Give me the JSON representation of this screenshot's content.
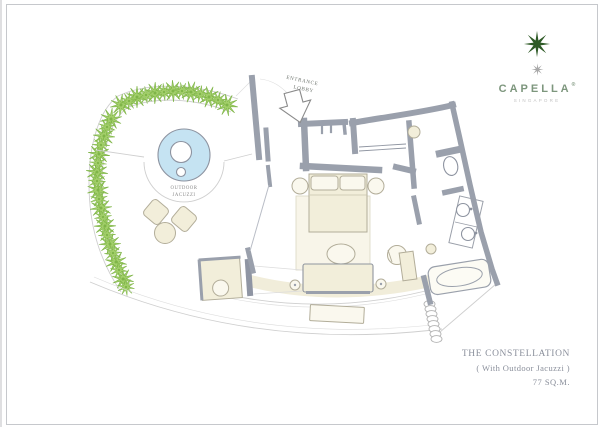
{
  "page": {
    "background": "#ffffff",
    "frame_color": "#c6c8cc"
  },
  "logo": {
    "brand": "CAPELLA",
    "trademark": "®",
    "location": "SINGAPORE",
    "star_color": "#2e5a26",
    "small_star_color": "#a8a8a8",
    "brand_color": "#7d967d",
    "location_color": "#c2c2c2"
  },
  "plan": {
    "labels": {
      "entrance_line1": "ENTRANCE",
      "entrance_line2": "LOBBY",
      "jacuzzi_line1": "OUTDOOR",
      "jacuzzi_line2": "JACUZZI"
    },
    "colors": {
      "wall": "#9aa0ac",
      "furniture_fill": "#f2eeda",
      "furniture_stroke": "#b2ad99",
      "plant_fill": "#a3cf6b",
      "plant_stroke": "#7fb548",
      "pool_fill": "#c5e3f2",
      "outline": "#c9c9c9",
      "label_text": "#8a8a8a",
      "entrance_text": "#6f756f"
    }
  },
  "title_block": {
    "name": "THE CONSTELLATION",
    "subtitle": "( With Outdoor Jacuzzi )",
    "area": "77 SQ.M.",
    "text_color": "#8a8f9b"
  }
}
